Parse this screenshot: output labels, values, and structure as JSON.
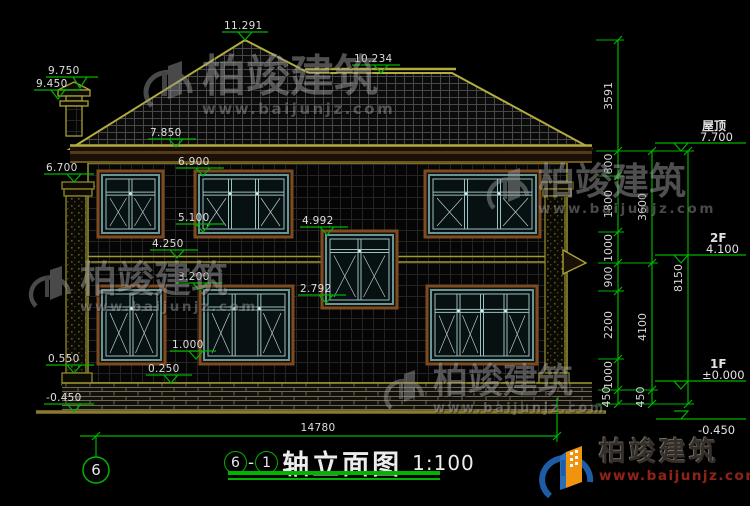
{
  "title_block": {
    "axis_start": "6",
    "separator": "-",
    "axis_end": "1",
    "title": "轴立面图",
    "scale": "1:100"
  },
  "axis_bubble": "6",
  "dims": {
    "bottom": "14780",
    "col1": [
      "3591",
      "800",
      "1800",
      "1000",
      "900",
      "2200",
      "1000",
      "450"
    ],
    "col2": [
      "3600",
      "4100",
      "450"
    ],
    "col3": [
      "8150"
    ]
  },
  "left_markers": [
    "11.291",
    "10.234",
    "9.750",
    "9.450",
    "7.850",
    "6.900",
    "6.700",
    "5.100",
    "4.992",
    "4.250",
    "3.200",
    "2.792",
    "1.000",
    "0.550",
    "0.250",
    "-0.450"
  ],
  "right_levels": {
    "roof_name": "屋顶",
    "roof_value": "7.700",
    "f2_name": "2F",
    "f2_value": "4.100",
    "f1_name": "1F",
    "f1_value": "±0.000",
    "ground_value": "-0.450"
  },
  "watermark": {
    "brand": "柏竣建筑",
    "url": "www.baijunjz.com"
  },
  "logo": {
    "brand": "柏竣建筑",
    "url": "www.baijunjz.com"
  }
}
